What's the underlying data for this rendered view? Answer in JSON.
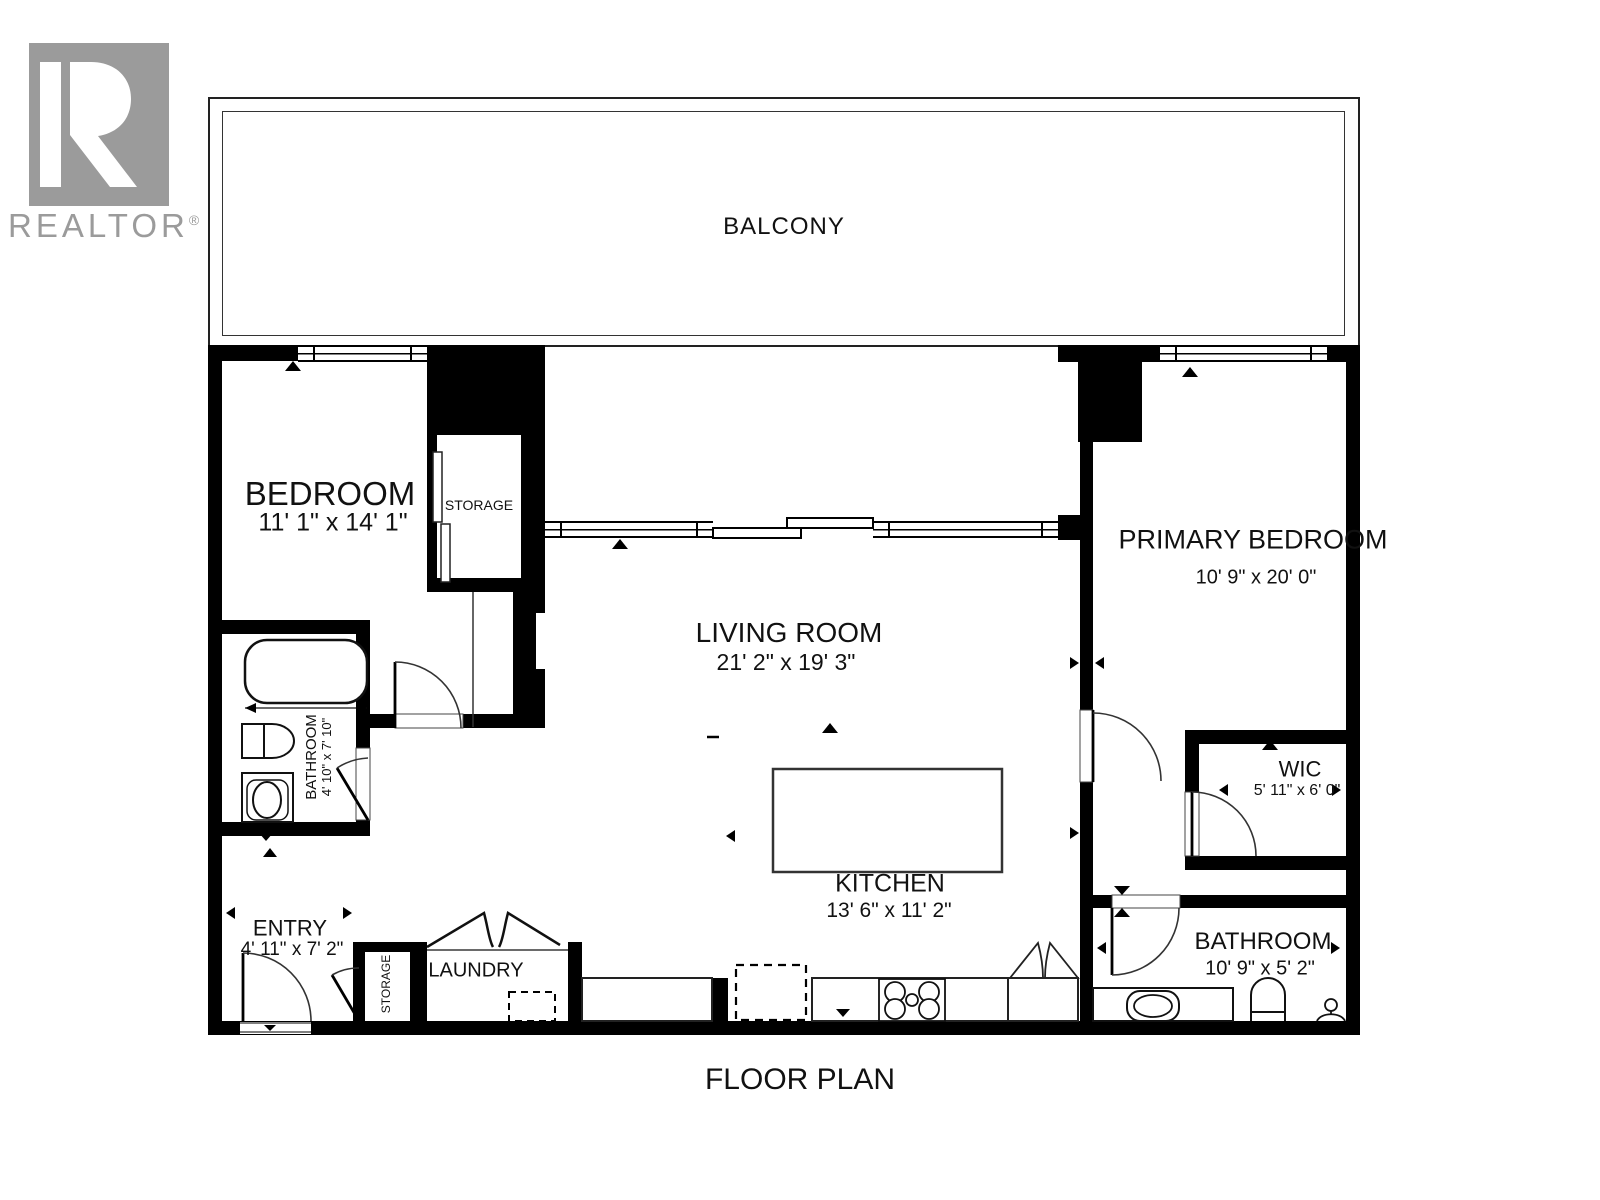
{
  "logo": {
    "brand": "REALTOR",
    "registered": "®"
  },
  "footer": {
    "title": "FLOOR PLAN"
  },
  "rooms": {
    "balcony": {
      "name": "BALCONY"
    },
    "bedroom": {
      "name": "BEDROOM",
      "dims": "11' 1\" x 14' 1\""
    },
    "storage_top": {
      "name": "STORAGE"
    },
    "living_room": {
      "name": "LIVING ROOM",
      "dims": "21' 2\" x 19' 3\""
    },
    "primary_bedroom": {
      "name": "PRIMARY BEDROOM",
      "dims": "10' 9\" x 20' 0\""
    },
    "wic": {
      "name": "WIC",
      "dims": "5' 11\" x 6' 0\""
    },
    "kitchen": {
      "name": "KITCHEN",
      "dims": "13' 6\" x 11' 2\""
    },
    "bathroom_left": {
      "name": "BATHROOM",
      "dims": "4' 10\" x 7' 10\""
    },
    "bathroom_main": {
      "name": "BATHROOM",
      "dims": "10' 9\" x 5' 2\""
    },
    "entry": {
      "name": "ENTRY",
      "dims": "4' 11\" x 7' 2\""
    },
    "laundry": {
      "name": "LAUNDRY"
    },
    "storage_entry": {
      "name": "STORAGE"
    }
  },
  "colors": {
    "wall": "#000000",
    "logo_gray": "#9b9b9b",
    "line": "#333333"
  }
}
